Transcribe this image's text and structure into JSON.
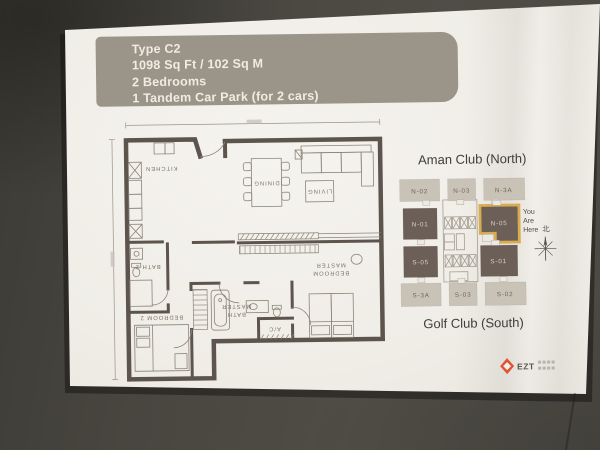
{
  "spec_box": {
    "lines": [
      "Type C2",
      "1098 Sq Ft / 102 Sq M",
      "2 Bedrooms",
      "1 Tandem Car Park (for 2 cars)"
    ]
  },
  "floor_plan": {
    "rooms": {
      "kitchen": "KITCHEN",
      "dining": "DINING",
      "living": "LIVING",
      "bath2": "BATH 2",
      "bedroom2": "BEDROOM 2",
      "master_bath_line1": "MASTER",
      "master_bath_line2": "BATH",
      "master_bedroom_line1": "MASTER",
      "master_bedroom_line2": "BEDROOM",
      "ac": "A/C"
    }
  },
  "key_plan": {
    "north_title": "Aman Club (North)",
    "south_title": "Golf Club (South)",
    "units": {
      "n02": "N-02",
      "n03": "N-03",
      "n3a": "N-3A",
      "n01": "N-01",
      "n05": "N-05",
      "s05": "S-05",
      "s01": "S-01",
      "s3a": "S-3A",
      "s03": "S-03",
      "s02": "S-02"
    },
    "you_are_here": {
      "l1": "You",
      "l2": "Are",
      "l3": "Here"
    },
    "compass_north_char": "北",
    "highlight_color": "#d9ad4f"
  },
  "logo": {
    "text": "EZT",
    "color": "#e0532f"
  },
  "colors": {
    "wall": "#4a4840",
    "paper": "#f0ede7",
    "spec_box_bg": "#9b9489",
    "plan_wall": "#5c544d",
    "unit_light": "#c9c2b6",
    "unit_dark": "#6b5f58"
  }
}
